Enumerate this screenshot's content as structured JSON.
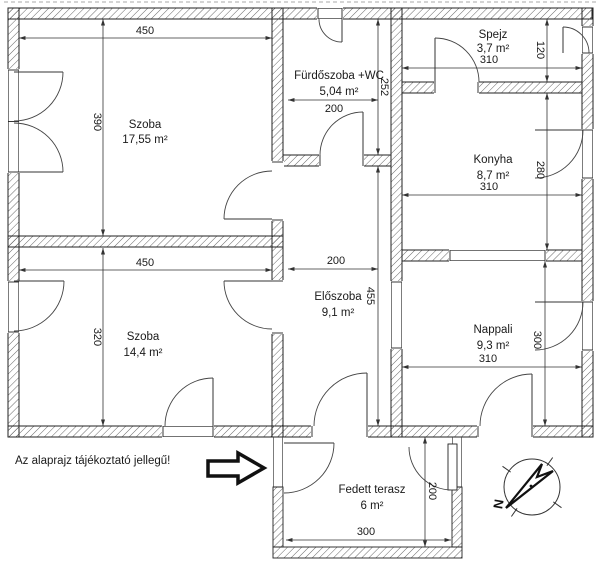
{
  "note": "Az alaprajz tájékoztató jellegű!",
  "compass": {
    "label": "N"
  },
  "rooms": {
    "szoba1": {
      "name": "Szoba",
      "area": "17,55 m²",
      "width": "450",
      "height": "390"
    },
    "furdoszoba": {
      "name": "Fürdőszoba +WC",
      "area": "5,04 m²",
      "width": "200",
      "height": "252"
    },
    "spejz": {
      "name": "Spejz",
      "area": "3,7 m²",
      "width": "310",
      "height": "120"
    },
    "konyha": {
      "name": "Konyha",
      "area": "8,7 m²",
      "width": "310",
      "height": "280"
    },
    "szoba2": {
      "name": "Szoba",
      "area": "14,4 m²",
      "width": "450",
      "height": "320"
    },
    "eloszoba": {
      "name": "Előszoba",
      "area": "9,1 m²",
      "width": "200",
      "height": "455"
    },
    "nappali": {
      "name": "Nappali",
      "area": "9,3 m²",
      "width": "310",
      "height": "300"
    },
    "terasz": {
      "name": "Fedett terasz",
      "area": "6 m²",
      "width": "300",
      "height": "200"
    }
  }
}
